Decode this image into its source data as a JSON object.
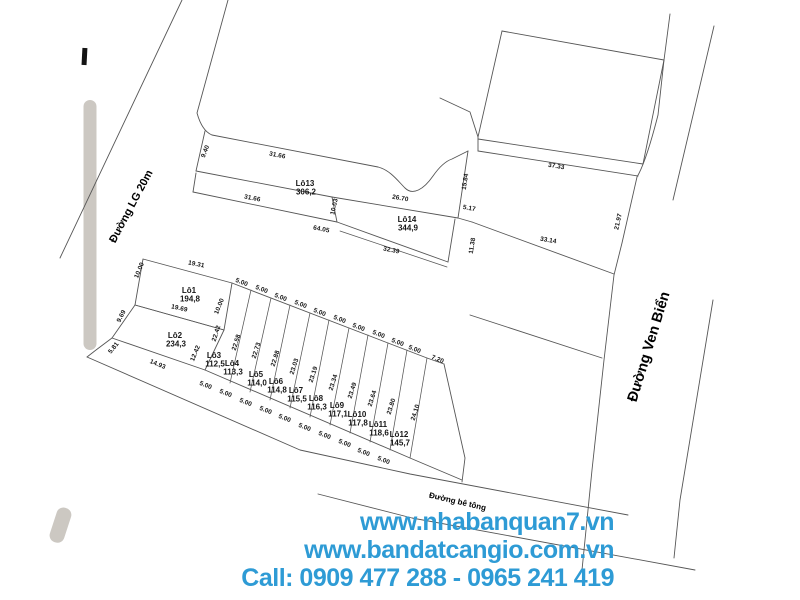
{
  "accent_color": "#2e9bd5",
  "footer": {
    "lines": [
      "www.nhabanquan7.vn",
      "www.bandatcangio.com.vn",
      "Call: 0909 477 288 - 0965 241 419"
    ]
  },
  "roads": [
    {
      "label": "Đường LG 20m",
      "x": 134,
      "y": 208,
      "rotate": -62,
      "size": 11
    },
    {
      "label": "Đường Ven Biển",
      "x": 653,
      "y": 348,
      "rotate": -73,
      "size": 14.5
    },
    {
      "label": "Đường bê tông",
      "x": 457,
      "y": 504,
      "rotate": 13,
      "size": 8
    }
  ],
  "plots": [
    {
      "id": "Lô1",
      "area": "194,8",
      "x": 189,
      "y": 293
    },
    {
      "id": "Lô2",
      "area": "234,3",
      "x": 175,
      "y": 338
    },
    {
      "id": "Lô3",
      "area": "112,5",
      "x": 214,
      "y": 358
    },
    {
      "id": "Lô4",
      "area": "113,3",
      "x": 232,
      "y": 366
    },
    {
      "id": "Lô5",
      "area": "114,0",
      "x": 256,
      "y": 377
    },
    {
      "id": "Lô6",
      "area": "114,8",
      "x": 276,
      "y": 384
    },
    {
      "id": "Lô7",
      "area": "115,5",
      "x": 296,
      "y": 393
    },
    {
      "id": "Lô8",
      "area": "116,3",
      "x": 316,
      "y": 401
    },
    {
      "id": "Lô9",
      "area": "117,1",
      "x": 337,
      "y": 408
    },
    {
      "id": "Lô10",
      "area": "117,8",
      "x": 357,
      "y": 417
    },
    {
      "id": "Lô11",
      "area": "118,6",
      "x": 378,
      "y": 427
    },
    {
      "id": "Lô12",
      "area": "145,7",
      "x": 399,
      "y": 437
    },
    {
      "id": "Lô13",
      "area": "306,2",
      "x": 305,
      "y": 186
    },
    {
      "id": "Lô14",
      "area": "344,9",
      "x": 407,
      "y": 222
    }
  ],
  "dimensions": [
    [
      "9.40",
      207,
      152,
      -68
    ],
    [
      "31.66",
      277,
      157,
      11
    ],
    [
      "31.66",
      252,
      200,
      11
    ],
    [
      "10.03",
      336,
      207,
      -78
    ],
    [
      "26.70",
      400,
      200,
      10
    ],
    [
      "64.05",
      321,
      231,
      11
    ],
    [
      "32.39",
      391,
      252,
      11
    ],
    [
      "15.84",
      467,
      182,
      -81
    ],
    [
      "5.17",
      469,
      210,
      10
    ],
    [
      "11.38",
      474,
      246,
      -81
    ],
    [
      "37.33",
      556,
      168,
      9
    ],
    [
      "21.97",
      620,
      222,
      -78
    ],
    [
      "33.14",
      548,
      242,
      10
    ],
    [
      "19.31",
      196,
      266,
      11
    ],
    [
      "10.00",
      141,
      271,
      -68
    ],
    [
      "10.00",
      221,
      307,
      -68
    ],
    [
      "19.69",
      179,
      310,
      12
    ],
    [
      "9.69",
      123,
      317,
      -64
    ],
    [
      "22.42",
      218,
      334,
      -72
    ],
    [
      "12.42",
      197,
      354,
      -68
    ],
    [
      "5.81",
      115,
      349,
      -52
    ],
    [
      "14.93",
      157,
      366,
      22
    ],
    [
      "7.20",
      437,
      361,
      22
    ],
    [
      "22.58",
      238,
      343,
      -72
    ],
    [
      "22.73",
      258,
      351,
      -72
    ],
    [
      "22.88",
      277,
      359,
      -72
    ],
    [
      "23.03",
      296,
      367,
      -72
    ],
    [
      "23.19",
      315,
      375,
      -72
    ],
    [
      "23.34",
      335,
      383,
      -72
    ],
    [
      "23.49",
      354,
      391,
      -72
    ],
    [
      "23.64",
      374,
      399,
      -72
    ],
    [
      "23.80",
      393,
      407,
      -72
    ],
    [
      "24.10",
      417,
      413,
      -72
    ],
    [
      "5.00",
      241,
      284,
      22
    ],
    [
      "5.00",
      261,
      291,
      22
    ],
    [
      "5.00",
      280,
      299,
      22
    ],
    [
      "5.00",
      300,
      306,
      22
    ],
    [
      "5.00",
      319,
      314,
      22
    ],
    [
      "5.00",
      339,
      321,
      22
    ],
    [
      "5.00",
      358,
      329,
      22
    ],
    [
      "5.00",
      378,
      336,
      22
    ],
    [
      "5.00",
      397,
      344,
      22
    ],
    [
      "5.00",
      414,
      351,
      22
    ],
    [
      "5.00",
      205,
      387,
      22
    ],
    [
      "5.00",
      225,
      395,
      22
    ],
    [
      "5.00",
      245,
      404,
      22
    ],
    [
      "5.00",
      265,
      412,
      22
    ],
    [
      "5.00",
      284,
      420,
      22
    ],
    [
      "5.00",
      304,
      429,
      22
    ],
    [
      "5.00",
      324,
      437,
      22
    ],
    [
      "5.00",
      344,
      445,
      22
    ],
    [
      "5.00",
      363,
      454,
      22
    ],
    [
      "5.00",
      383,
      462,
      22
    ]
  ]
}
